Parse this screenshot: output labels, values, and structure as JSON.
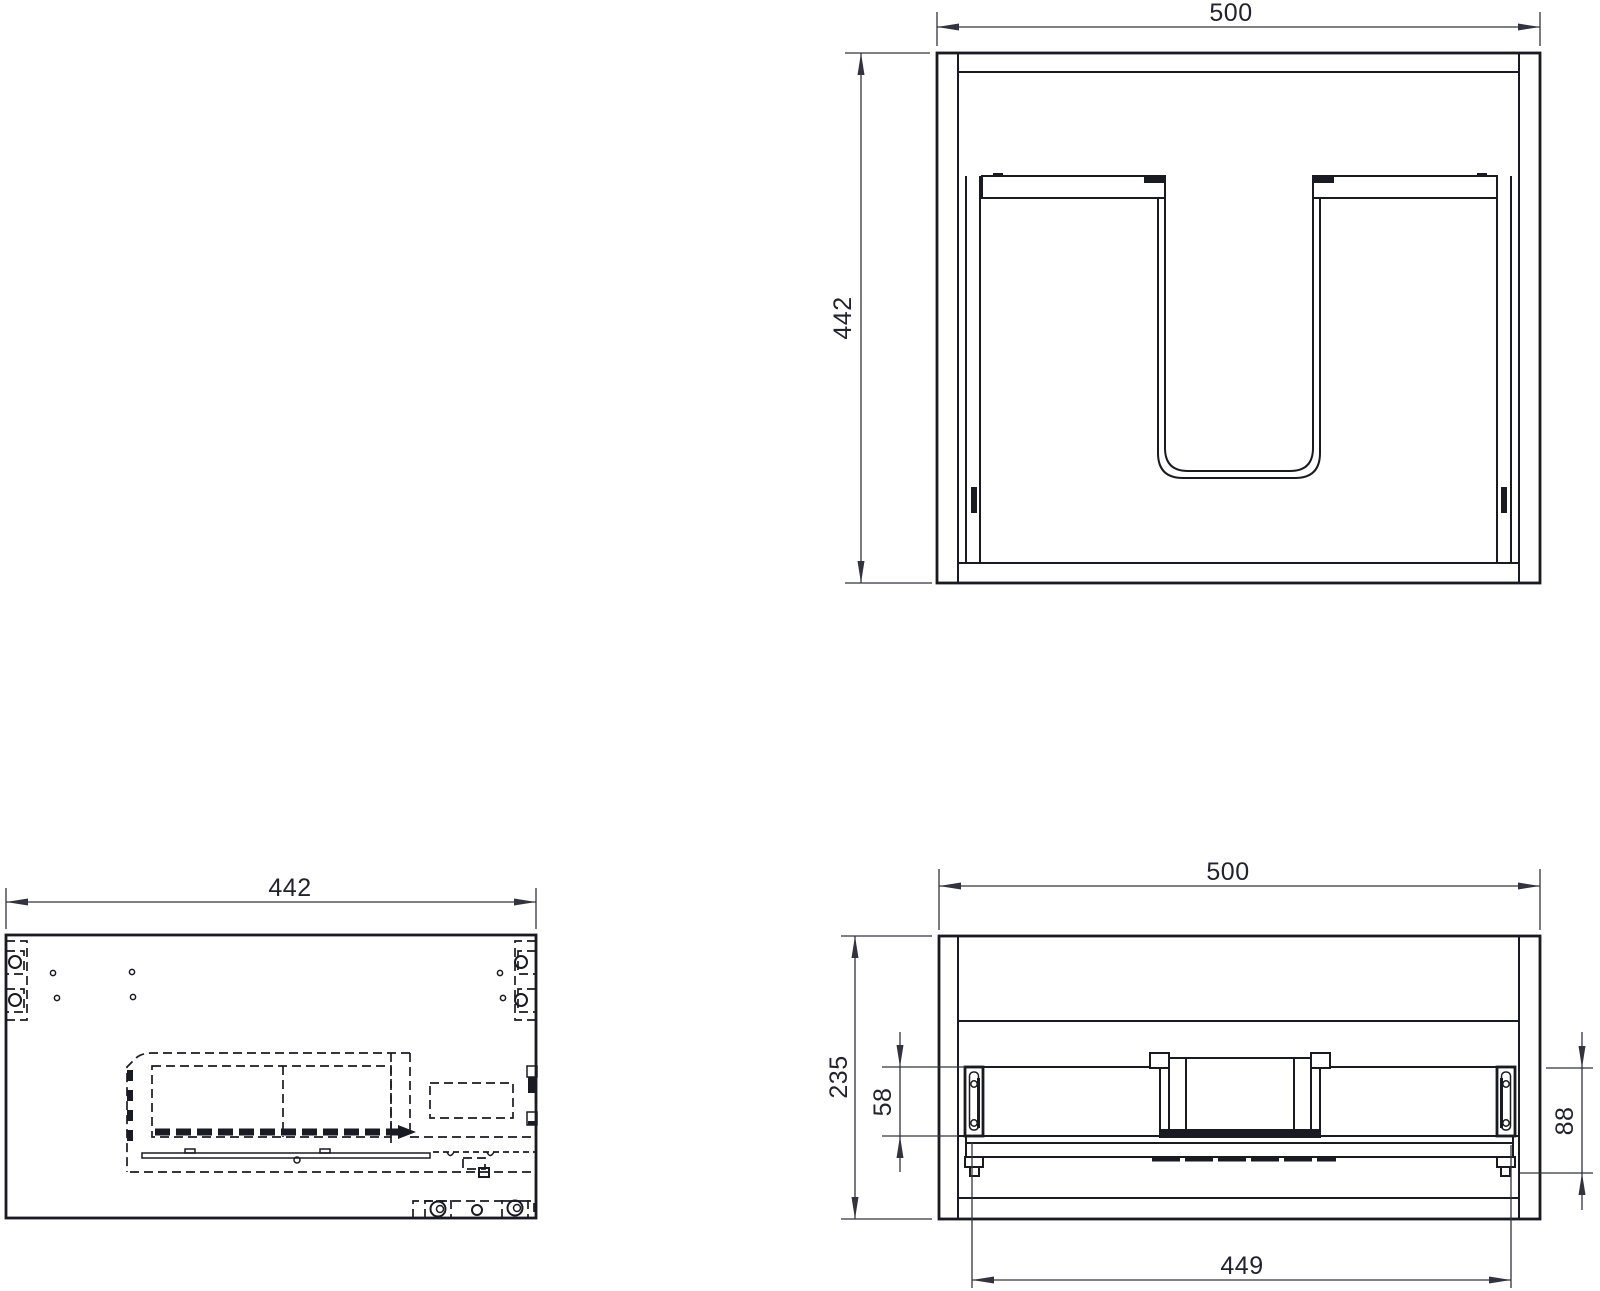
{
  "drawing": {
    "background": "#ffffff",
    "line_color": "#1a1a22",
    "text_color": "#23232f",
    "views": {
      "rear_elevation": {
        "width": "500",
        "height": "442"
      },
      "side_section": {
        "length": "442"
      },
      "plan": {
        "width": "500",
        "depth": "235",
        "rail_offset": "58",
        "bracket_drop": "88",
        "fixing_centres": "449"
      }
    }
  }
}
